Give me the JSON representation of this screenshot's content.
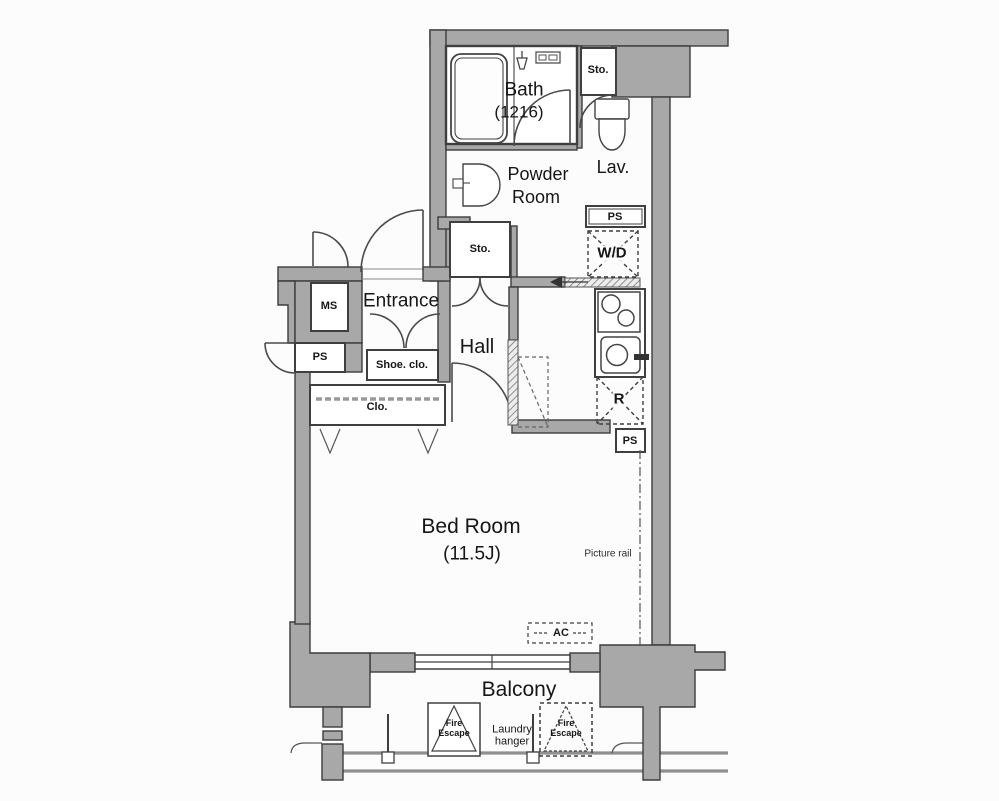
{
  "colors": {
    "wall_fill": "#a8a8a8",
    "wall_outline": "#3c3c3c",
    "line_color": "#4a4a4a",
    "text": "#161616",
    "background": "#fcfcfc"
  },
  "icons": [
    "bathtub-icon",
    "shower-icon",
    "bath-control-panel-icon",
    "washbasin-icon",
    "toilet-icon",
    "stove-icon",
    "kitchen-sink-icon",
    "laundry-pole-icon",
    "fire-escape-hatch-icon",
    "door-arc-icon",
    "sliding-door-icon"
  ],
  "floor_plan": {
    "rooms": {
      "bath": {
        "name": "Bath",
        "size": "(1216)"
      },
      "powder_room": {
        "line1": "Powder",
        "line2": "Room"
      },
      "lavatory": {
        "name": "Lav."
      },
      "entrance": {
        "name": "Entrance"
      },
      "hall": {
        "name": "Hall"
      },
      "bedroom": {
        "name": "Bed Room",
        "size": "(11.5J)"
      },
      "balcony": {
        "name": "Balcony"
      }
    },
    "labels": {
      "storage_top": "Sto.",
      "storage_hall": "Sto.",
      "shoe_closet": "Shoe. clo.",
      "closet": "Clo.",
      "meter_space": "MS",
      "pipe_space_left": "PS",
      "pipe_space_top": "PS",
      "pipe_space_bottom": "PS",
      "washer_dryer": "W/D",
      "refrigerator": "R",
      "air_conditioner": "AC",
      "picture_rail": "Picture rail",
      "fire_escape": {
        "line1": "Fire",
        "line2": "Escape"
      },
      "laundry_hanger": {
        "line1": "Laundry",
        "line2": "hanger"
      }
    }
  }
}
